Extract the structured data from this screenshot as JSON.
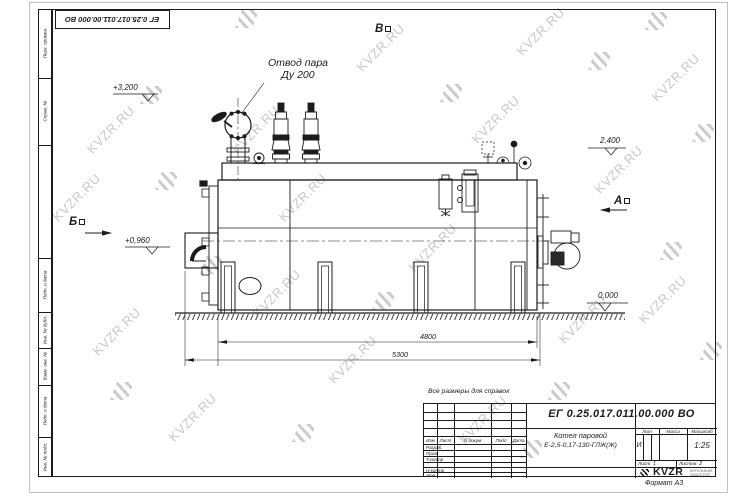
{
  "watermark": {
    "text": "KVZR.RU"
  },
  "stamp_top": {
    "number": "ЕГ 0.25.017.011.00.000  ВО"
  },
  "view_markers": {
    "a": "А",
    "b": "Б",
    "v": "В"
  },
  "elevations": {
    "top": "+3,200",
    "right": "2,400",
    "mid": "+0,960",
    "zero": "0,000"
  },
  "dimensions": {
    "inner": "4800",
    "overall": "5300"
  },
  "callouts": {
    "steam_line1": "Отвод пара",
    "steam_line2": "Ду 200"
  },
  "note": "Все размеры для справок",
  "titleblock": {
    "doc_number": "ЕГ 0.25.017.011.00.000  ВО",
    "product_line1": "Котел паровой",
    "product_line2": "Е-2,5-0,17-130-ГЛЖ(Ж)",
    "columns": {
      "izm": "Изм",
      "list": "Лист",
      "ndocum": "N докум",
      "podp": "Подп",
      "data": "Дата"
    },
    "rows": [
      "Разраб.",
      "Пров.",
      "Т.контр",
      "Н.контр",
      "Утв."
    ],
    "lit_label": "Лит",
    "mass_label": "Масса",
    "scale_label": "Масштаб",
    "lit_value": "И",
    "scale_value": "1:25",
    "sheet_label": "Лист",
    "sheet_value": "1",
    "sheets_label": "Листов",
    "sheets_value": "2",
    "logo_text": "KVZR",
    "logo_tag1": "КОТЕЛЬНЫЙ",
    "logo_tag2": "ЗАВОД РЭП",
    "format_note": "Формат А3"
  },
  "margin_labels": {
    "perv": "Перв. примен.",
    "sprav": "Справ. №",
    "podp_data_1": "Подп. и дата",
    "inv_dubl": "Инв. № дубл.",
    "vzam_inv": "Взам. инв. №",
    "podp_data_2": "Подп. и дата",
    "inv_podl": "Инв. № подл."
  }
}
